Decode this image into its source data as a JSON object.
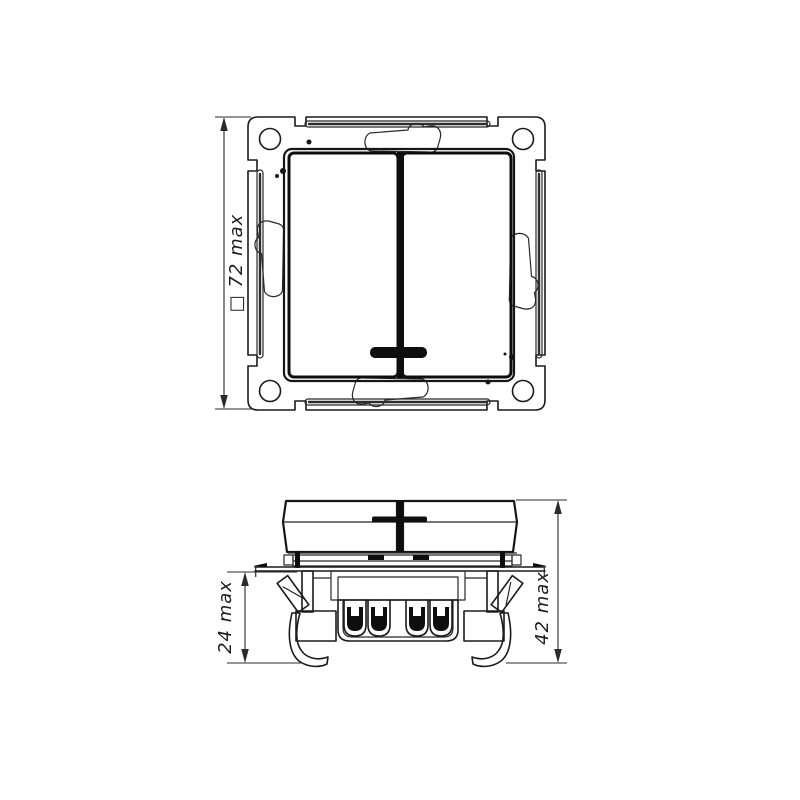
{
  "canvas": {
    "background": "#ffffff",
    "ink": "#1b1b1b",
    "dim_color": "#2b2b2b"
  },
  "dimensions": {
    "front_size": "□ 72 max",
    "mounting_depth": "24 max",
    "total_depth": "42 max"
  }
}
